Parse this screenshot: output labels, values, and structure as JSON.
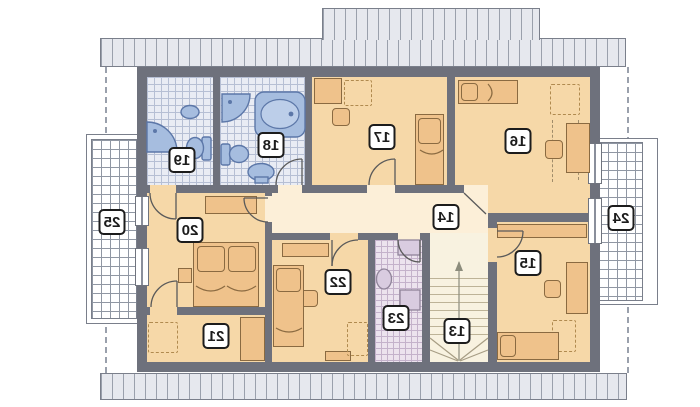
{
  "plan": {
    "rooms": [
      {
        "label": "13",
        "name": "staircase"
      },
      {
        "label": "14",
        "name": "corridor"
      },
      {
        "label": "15",
        "name": "bedroom"
      },
      {
        "label": "16",
        "name": "bedroom"
      },
      {
        "label": "17",
        "name": "bedroom"
      },
      {
        "label": "18",
        "name": "bathroom"
      },
      {
        "label": "19",
        "name": "bathroom"
      },
      {
        "label": "20",
        "name": "bedroom"
      },
      {
        "label": "21",
        "name": "room"
      },
      {
        "label": "22",
        "name": "bedroom"
      },
      {
        "label": "23",
        "name": "laundry"
      },
      {
        "label": "24",
        "name": "balcony"
      },
      {
        "label": "25",
        "name": "balcony"
      }
    ],
    "colors": {
      "wall": "#6e717c",
      "room_floor": "#f6d8a8",
      "corridor_floor": "#fcefd8",
      "bath_tile": "#e9ecf4",
      "laundry_tile": "#ece3ee",
      "fixture_blue": "#a6bddf",
      "fixture_lavender": "#d9cce0",
      "furniture": "#efc28b",
      "eave": "#e6e8ee"
    }
  }
}
